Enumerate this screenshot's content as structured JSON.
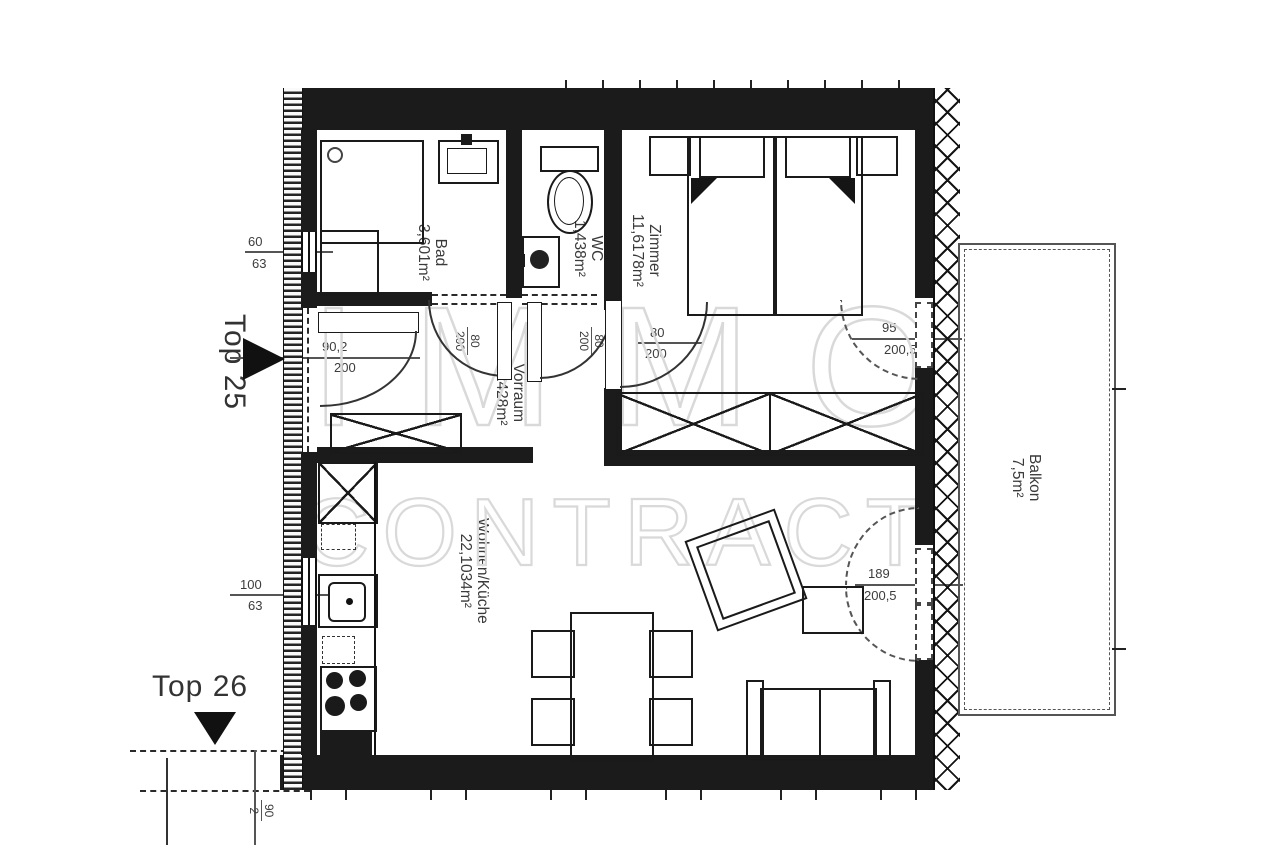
{
  "plan": {
    "units": {
      "top25": "Top 25",
      "top26": "Top 26"
    },
    "rooms": {
      "bad": {
        "name": "Bad",
        "area": "3,601m²"
      },
      "wc": {
        "name": "WC",
        "area": "1,438m²"
      },
      "zimmer": {
        "name": "Zimmer",
        "area": "11,6178m²"
      },
      "vorraum": {
        "name": "Vorraum",
        "area": "5,2428m²"
      },
      "wohnen": {
        "name": "Wohnen/Küche",
        "area": "22,1034m²"
      },
      "balkon": {
        "name": "Balkon",
        "area": "7,5m²"
      }
    },
    "dimensions": {
      "entranceDoor": {
        "w": "90,2",
        "h": "200"
      },
      "badDoor": {
        "w": "80",
        "h": "200"
      },
      "wcDoor": {
        "w": "80",
        "h": "200"
      },
      "zimmerDoor": {
        "w": "80",
        "h": "200"
      },
      "zimmerBalconyDoor": {
        "w": "95",
        "h": "200,5"
      },
      "wohnenBalconyDoor": {
        "w": "189",
        "h": "200,5"
      },
      "badWindow": {
        "w": "60",
        "h": "63"
      },
      "kitchenWindow": {
        "w": "100",
        "h": "63"
      },
      "top26Door": {
        "w": "90",
        "h": "2"
      }
    },
    "watermark": {
      "line1": "IMMO",
      "line2": "CONTRACT"
    },
    "colors": {
      "wall": "#1b1b1b",
      "line": "#333333",
      "dim": "#3c3c3c",
      "watermark": "#d9d9d9"
    }
  }
}
